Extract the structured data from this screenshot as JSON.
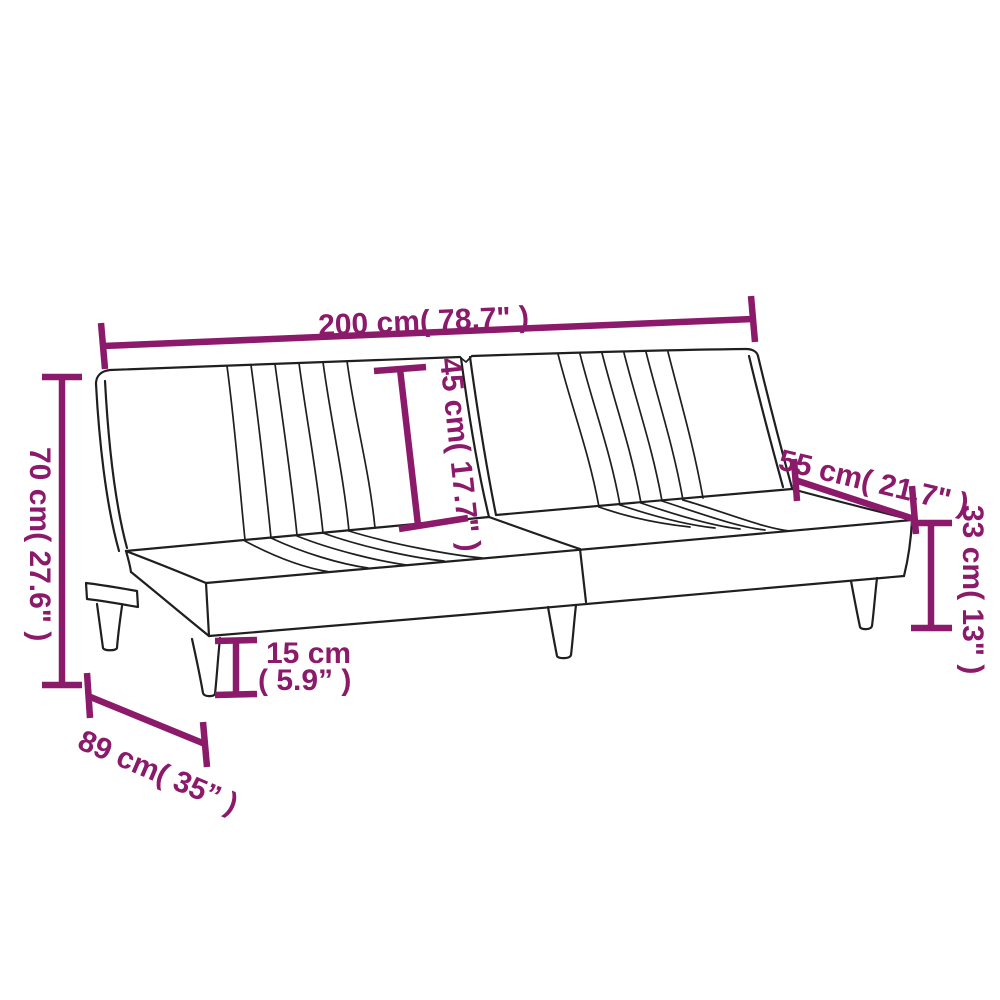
{
  "diagram": {
    "kind": "product-dimension-diagram",
    "subject": "sofa-bed-line-drawing",
    "background_color": "#ffffff",
    "accent_color": "#8B1A6B",
    "outline_color": "#1f1f1f",
    "dimensions": {
      "overall_width": {
        "value_cm": 200,
        "value_in": "78.7",
        "label": "200 cm( 78.7\" )"
      },
      "backrest_height": {
        "value_cm": 45,
        "value_in": "17.7",
        "label": "45 cm( 17.7\" )"
      },
      "seat_depth": {
        "value_cm": 55,
        "value_in": "21.7",
        "label": "55 cm( 21.7\" )"
      },
      "overall_height": {
        "value_cm": 70,
        "value_in": "27.6",
        "label": "70 cm( 27.6\" )"
      },
      "seat_height": {
        "value_cm": 33,
        "value_in": "13",
        "label": "33 cm( 13\" )"
      },
      "leg_height": {
        "value_cm": 15,
        "value_in": "5.9",
        "label_line1": "15 cm",
        "label_line2": "( 5.9” )"
      },
      "overall_depth": {
        "value_cm": 89,
        "value_in": "35",
        "label": "89 cm( 35” )"
      }
    }
  }
}
